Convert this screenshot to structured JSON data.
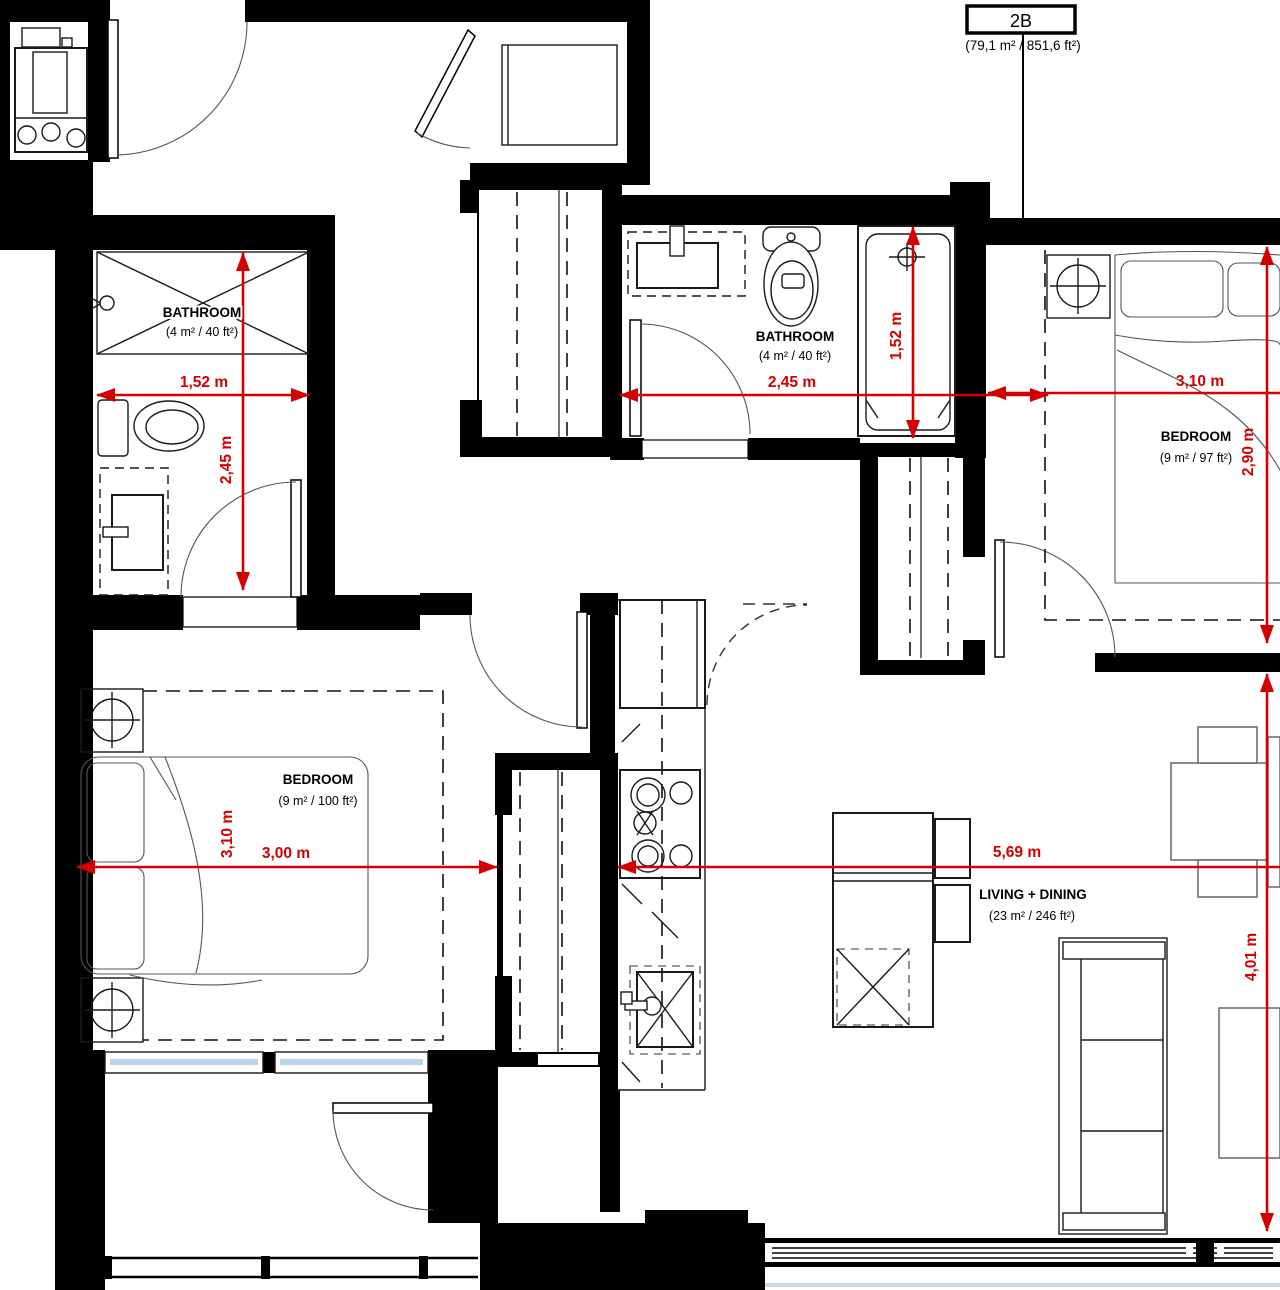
{
  "plan": {
    "unit": {
      "label": "2B",
      "area": "(79,1 m² / 851,6 ft²)"
    },
    "colors": {
      "wall": "#000000",
      "dimension_red": "#d40000",
      "window_blue": "#b8d4e8"
    },
    "rooms": {
      "bathroom1": {
        "name": "BATHROOM",
        "area": "(4 m² / 40 ft²)",
        "dim_w": "1,52 m",
        "dim_h": "2,45 m"
      },
      "bathroom2": {
        "name": "BATHROOM",
        "area": "(4 m² / 40 ft²)",
        "dim_w": "2,45 m",
        "dim_h": "1,52 m"
      },
      "bedroom1": {
        "name": "BEDROOM",
        "area": "(9 m² / 97 ft²)",
        "dim_w": "3,10 m",
        "dim_h": "2,90 m"
      },
      "bedroom2": {
        "name": "BEDROOM",
        "area": "(9 m² / 100 ft²)",
        "dim_w": "3,00 m",
        "dim_h": "3,10 m"
      },
      "living": {
        "name": "LIVING + DINING",
        "area": "(23 m² / 246 ft²)",
        "dim_w": "5,69 m",
        "dim_h": "4,01 m"
      }
    }
  }
}
